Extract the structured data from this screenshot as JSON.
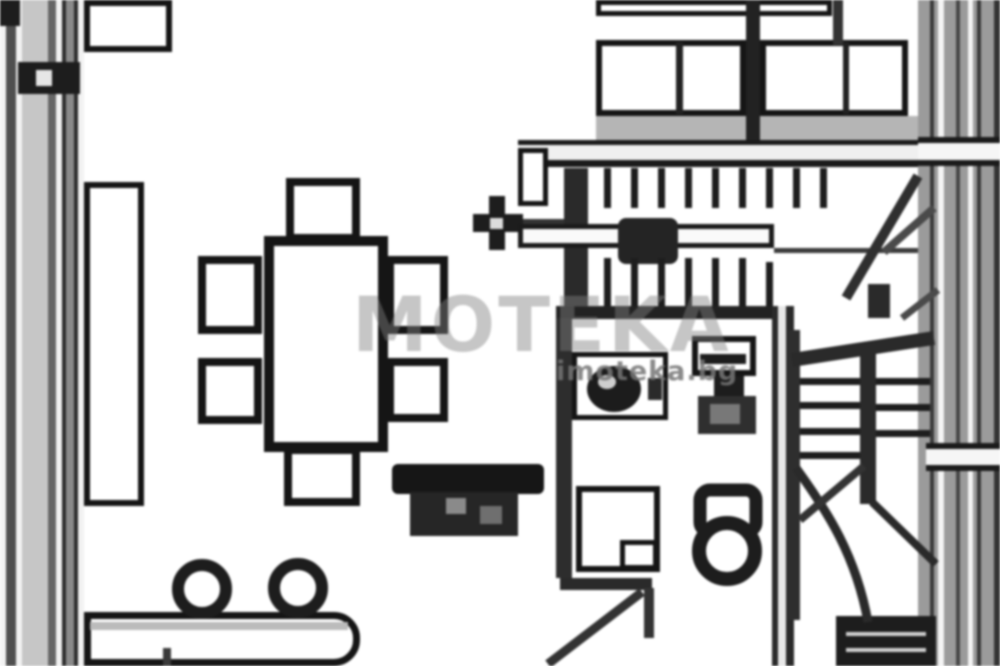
{
  "watermark": {
    "large_text": "MOTEKA",
    "small_text": "imoteka.bg"
  },
  "palette": {
    "background": "#ffffff",
    "ink": "#151515",
    "wall_dark": "#2d2d2d",
    "wall_gray": "#8f8f8f",
    "light_gray": "#c6c6c6",
    "shadow_gray": "#b5b5b5",
    "watermark_gray": "#808080"
  },
  "plan": {
    "type": "floor-plan",
    "objects": [
      "left-exterior-wall",
      "wall-anchor",
      "window-box",
      "tall-cabinet",
      "dining-table",
      "dining-chairs-x6",
      "bar-counter",
      "bar-stools-x2",
      "armchair",
      "door-symbol",
      "upper-staircase",
      "stair-treads",
      "top-cabinets",
      "right-exterior-wall",
      "bathroom",
      "shower-cabin",
      "sink-vanity",
      "washing-machine",
      "toilet",
      "door-swing",
      "lower-staircase",
      "stair-break-line",
      "landing-block"
    ]
  }
}
